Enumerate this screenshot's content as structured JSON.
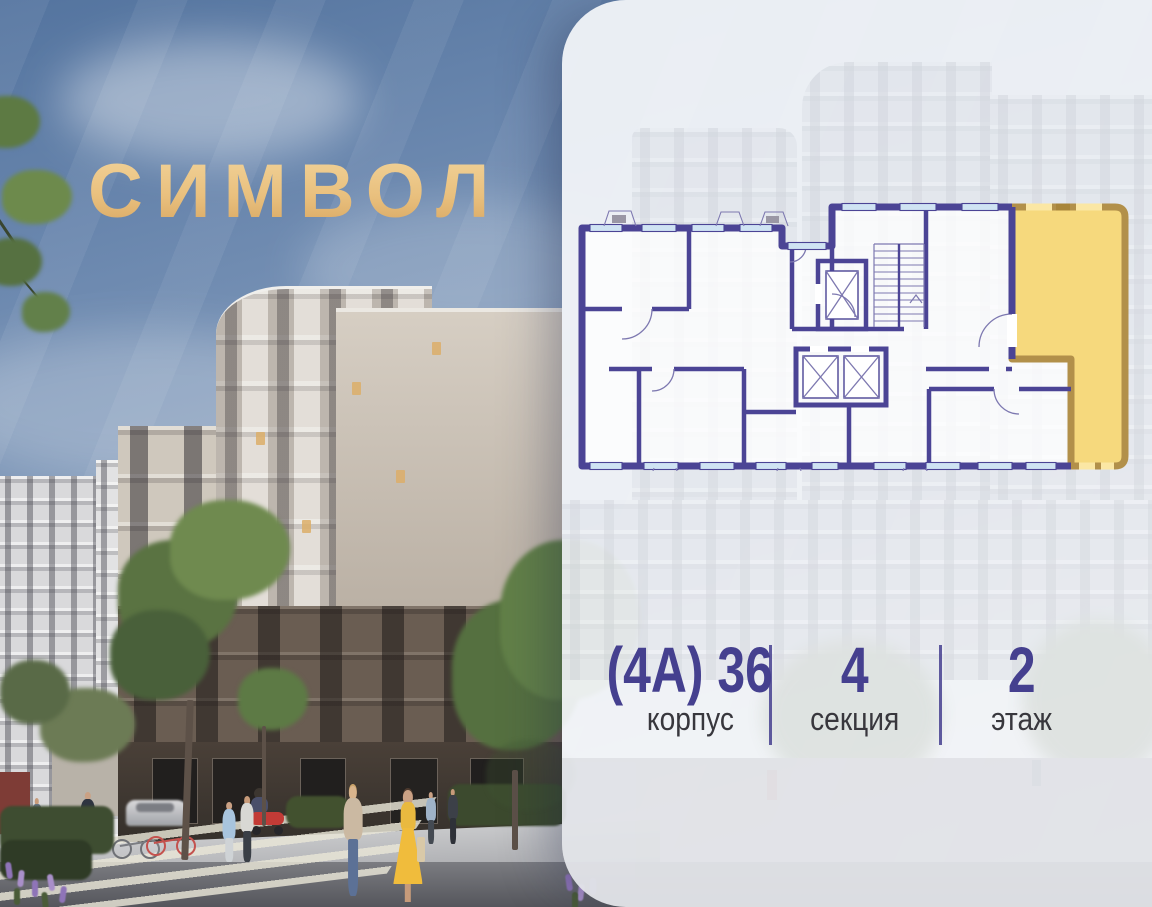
{
  "logo": {
    "text": "СИМВОЛ"
  },
  "panel": {
    "info": {
      "building": {
        "value": "(4А) 36",
        "label": "корпус"
      },
      "section": {
        "value": "4",
        "label": "секция"
      },
      "floor": {
        "value": "2",
        "label": "этаж"
      }
    },
    "floorplan": {
      "selected_apartment_highlighted": true
    }
  },
  "colors": {
    "accent-purple": "#45408f",
    "label-dark": "#38373d",
    "logo-gold": "#e9c07e",
    "panel-bg": "#f2f4f8",
    "plan-wall-purple": "#4b4495",
    "plan-window-blue": "#cfe3f3",
    "highlight-gold-fill": "#f6d97d",
    "highlight-gold-wall": "#b2904a"
  }
}
